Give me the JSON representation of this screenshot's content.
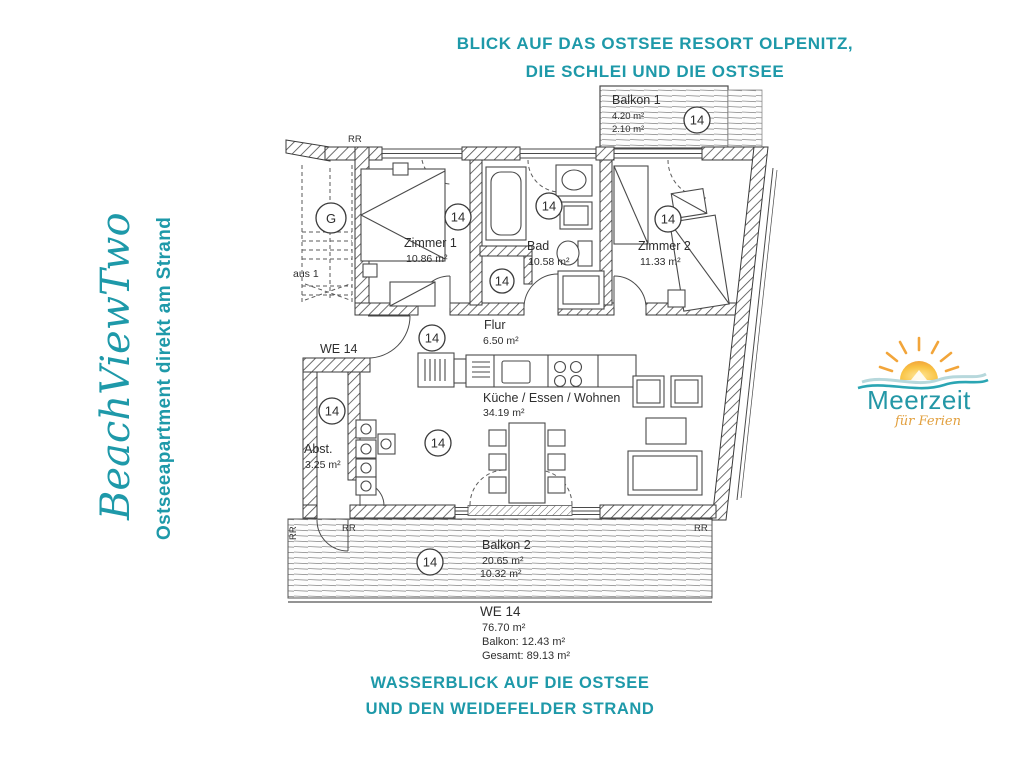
{
  "colors": {
    "teal": "#1e99a9",
    "plan_ink": "#3a3a3a",
    "logo_orange": "#f2a53a",
    "logo_script_orange": "#e2a03f"
  },
  "header": {
    "line1": "BLICK AUF DAS OSTSEE RESORT OLPENITZ,",
    "line2": "DIE SCHLEI UND DIE OSTSEE"
  },
  "footer": {
    "line1": "WASSERBLICK AUF DIE OSTSEE",
    "line2": "UND DEN WEIDEFELDER STRAND"
  },
  "sidebar": {
    "brand": "BeachViewTwo",
    "tagline": "Ostseeapartment direkt am Strand"
  },
  "logo": {
    "name": "Meerzeit",
    "tagline": "für Ferien"
  },
  "plan": {
    "badge": "14",
    "rr": "RR",
    "stair_circle": "G",
    "stair_text": "aus 1",
    "unit_label": "WE 14",
    "rooms": {
      "balkon1": {
        "name": "Balkon 1",
        "area_full": "4.20 m²",
        "area_half": "2.10 m²"
      },
      "zimmer1": {
        "name": "Zimmer 1",
        "area": "10.86 m²"
      },
      "bad": {
        "name": "Bad",
        "area": "10.58 m²"
      },
      "zimmer2": {
        "name": "Zimmer 2",
        "area": "11.33 m²"
      },
      "flur": {
        "name": "Flur",
        "area": "6.50 m²"
      },
      "wohnen": {
        "name": "Küche / Essen / Wohnen",
        "area": "34.19 m²"
      },
      "abst": {
        "name": "Abst.",
        "area": "3.25 m²"
      },
      "balkon2": {
        "name": "Balkon 2",
        "area_full": "20.65 m²",
        "area_half": "10.32 m²"
      }
    },
    "summary": {
      "unit": "WE 14",
      "wohnflaeche": "76.70 m²",
      "balkon": "Balkon: 12.43 m²",
      "gesamt": "Gesamt: 89.13 m²"
    }
  }
}
